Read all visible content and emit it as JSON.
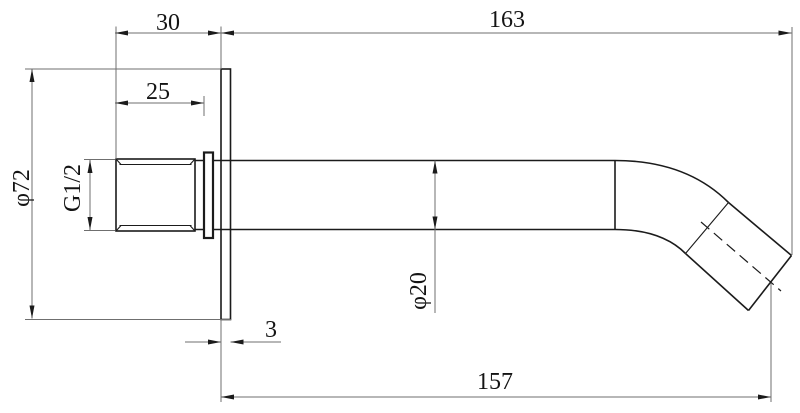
{
  "drawing": {
    "type": "technical-drawing",
    "subject": "wall-mounted-spout-side-view",
    "labels": {
      "dim_30": "30",
      "dim_163": "163",
      "dim_25": "25",
      "dim_phi72": "φ72",
      "dim_g12": "G1/2",
      "dim_phi20": "φ20",
      "dim_3": "3",
      "dim_157": "157"
    },
    "colors": {
      "background": "#ffffff",
      "object_line": "#1b1b1b",
      "thin_line": "#6f6f6f",
      "text": "#141414"
    }
  }
}
